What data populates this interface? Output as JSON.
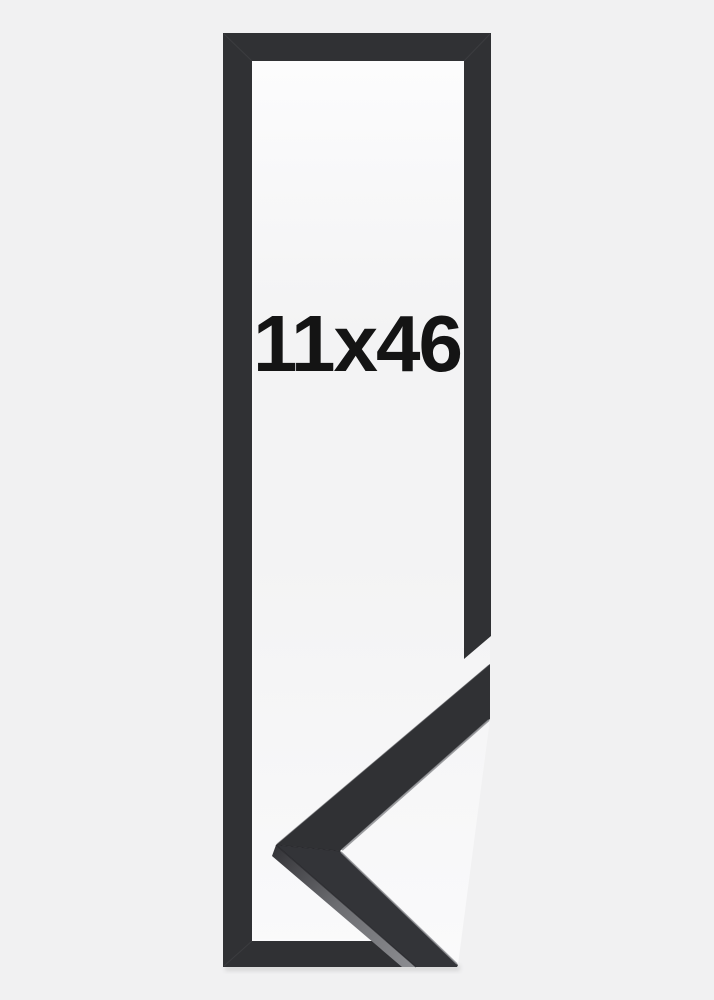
{
  "image": {
    "size_label": "11x46"
  },
  "colors": {
    "background": "#f1f1f2",
    "inner_white_top": "#fcfcfd",
    "inner_white_mid": "#f3f3f4",
    "inner_white_bottom": "#fafafb",
    "frame_dark": "#303134",
    "corner_face_upper": "#303134",
    "corner_face_lower": "#333438",
    "side_face_dark": "#36363a",
    "side_face_mid": "#6b6c70",
    "side_face_light": "#8a8b8f",
    "edge_highlight": "#8f9094",
    "edge_shadow_line": "#232327",
    "miter_seam": "#56575b",
    "drop_shadow": "#2a2a2a",
    "text": "#141414"
  }
}
